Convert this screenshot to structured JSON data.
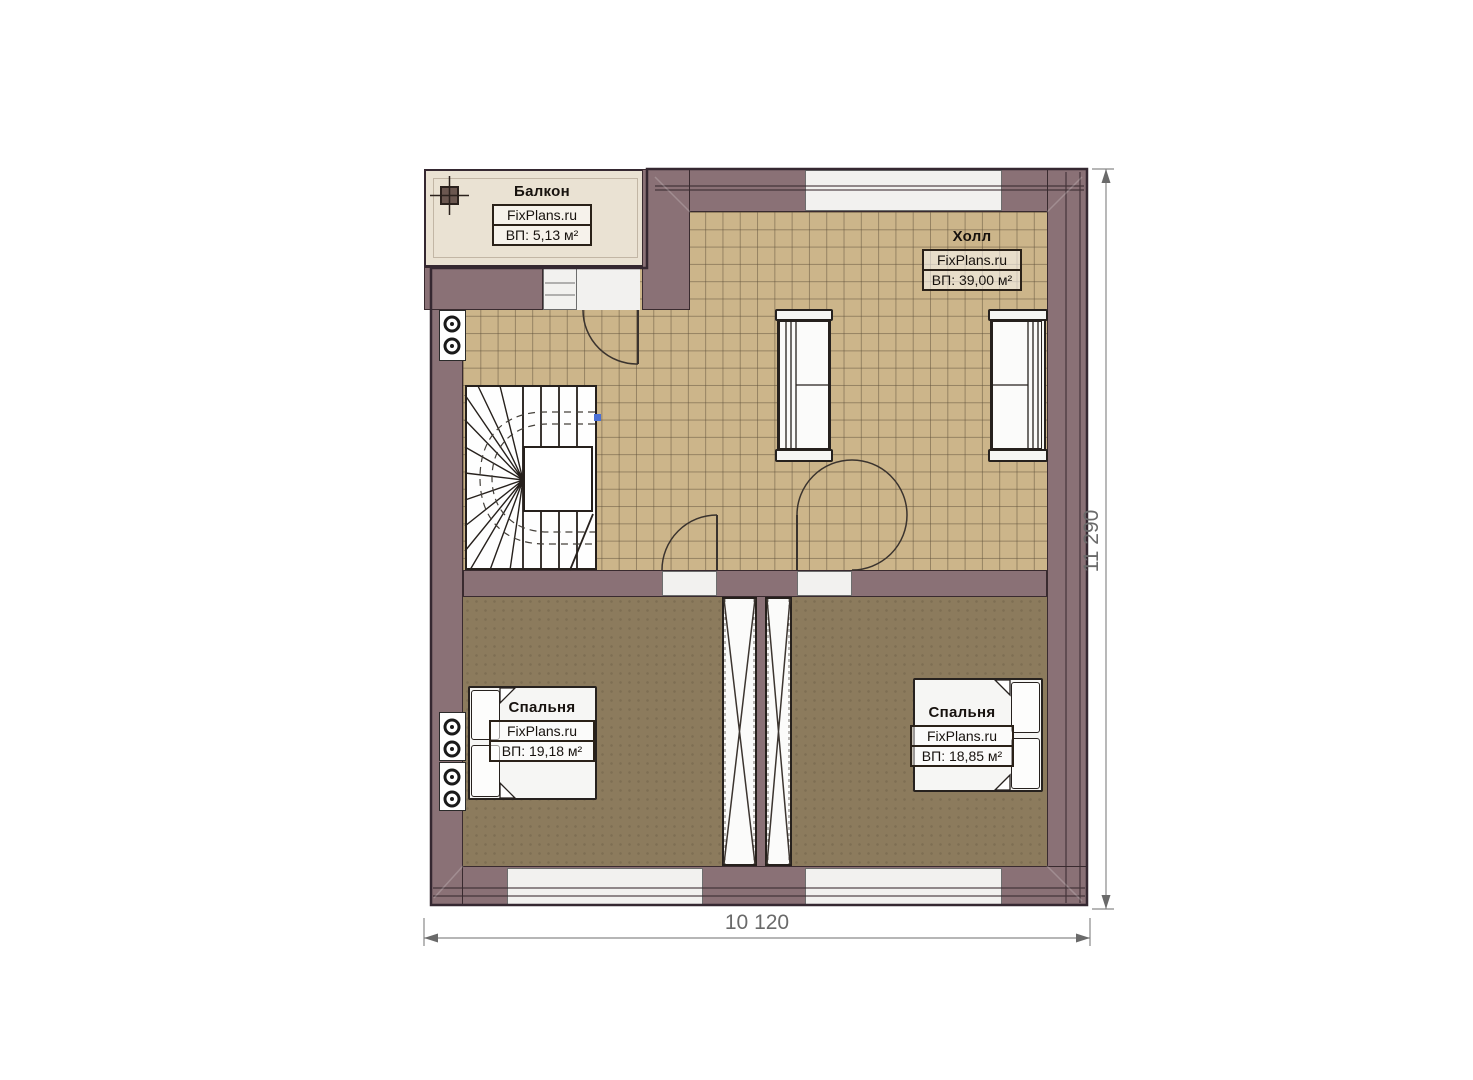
{
  "plan": {
    "type": "floor-plan-second-storey",
    "watermark": "FixPlans.ru",
    "rooms": {
      "balcony": {
        "title": "Балкон",
        "watermark": "FixPlans.ru",
        "area": "ВП: 5,13 м²"
      },
      "hall": {
        "title": "Холл",
        "watermark": "FixPlans.ru",
        "area": "ВП: 39,00 м²"
      },
      "bedroom_left": {
        "title": "Спальня",
        "watermark": "FixPlans.ru",
        "area": "ВП: 19,18 м²"
      },
      "bedroom_right": {
        "title": "Спальня",
        "watermark": "FixPlans.ru",
        "area": "ВП: 18,85 м²"
      }
    },
    "dimensions": {
      "width": "10 120",
      "height": "11 290"
    },
    "colors": {
      "wall": "#8a7176",
      "wall_outline": "#392a2f",
      "balcony_floor": "#eae2d3",
      "hall_tile_floor": "#ccb58a",
      "bedroom_floor": "#8c7b5d",
      "furniture_white": "#f6f6f4",
      "dimension_gray": "#6a6a6a",
      "stair_marker_blue": "#4a6fd4"
    }
  }
}
